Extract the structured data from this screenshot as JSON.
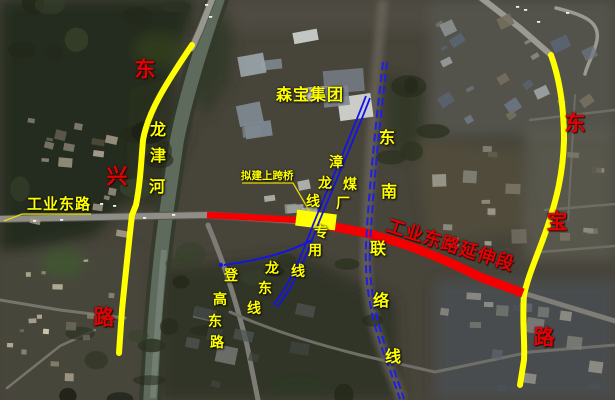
{
  "map": {
    "region_labels": {
      "senbao_group": "森宝集团",
      "longjin_river": "龙津河",
      "dongxing_road": "东兴路",
      "gongye_east_road": "工业东路",
      "proposed_bridge": "拟建上跨桥",
      "zhanglong_line": "漳龙线",
      "coal_plant_line": "煤厂专用线",
      "southeast_link_line": "东南联络线",
      "denggao_east_road": "登高东路",
      "longdong_line": "龙东线",
      "gongye_extension": "工业东路延伸段",
      "dongbao_road": "东宝路"
    },
    "colors": {
      "highlight_road": "#ffff00",
      "extension_segment": "#f40000",
      "railway_blue": "#1a1ae0",
      "label_yellow": "#ffff00",
      "label_red": "#e30202"
    }
  }
}
